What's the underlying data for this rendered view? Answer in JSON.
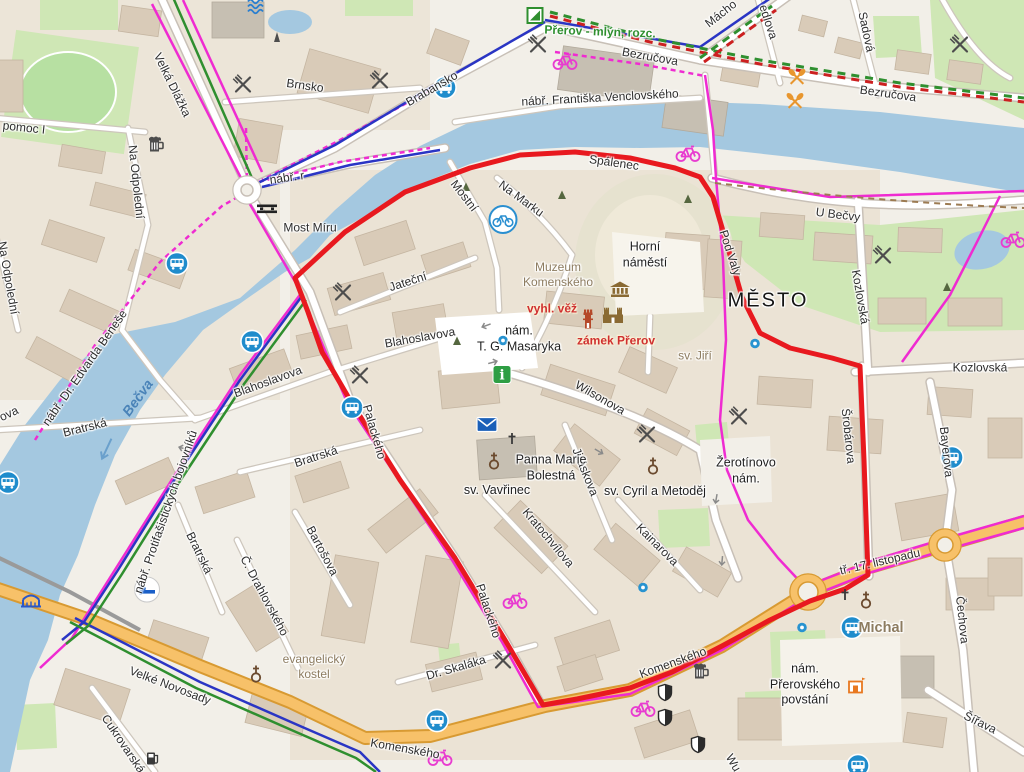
{
  "map": {
    "kind": "city-map",
    "city_label": "MĚSTO",
    "colors": {
      "water": "#a4c8e0",
      "land": "#f2efe8",
      "park": "#cfe7b5",
      "building": "#d9cbb8",
      "road_major": "#f7c169",
      "route_red": "#e8191f",
      "cycle_pink": "#ef2bd1",
      "cycle_blue": "#2a35c4",
      "hiking_green": "#2f8f2f",
      "hiking_red": "#cc2020"
    },
    "route": {
      "color": "#e8191f",
      "width": 5,
      "points": [
        [
          295,
          278
        ],
        [
          345,
          232
        ],
        [
          405,
          192
        ],
        [
          470,
          168
        ],
        [
          520,
          155
        ],
        [
          575,
          152
        ],
        [
          630,
          158
        ],
        [
          675,
          168
        ],
        [
          700,
          177
        ],
        [
          713,
          197
        ],
        [
          728,
          248
        ],
        [
          742,
          297
        ],
        [
          760,
          333
        ],
        [
          790,
          348
        ],
        [
          832,
          358
        ],
        [
          860,
          366
        ],
        [
          864,
          460
        ],
        [
          868,
          575
        ],
        [
          845,
          589
        ],
        [
          810,
          601
        ],
        [
          770,
          620
        ],
        [
          722,
          646
        ],
        [
          672,
          672
        ],
        [
          630,
          688
        ],
        [
          577,
          699
        ],
        [
          543,
          705
        ],
        [
          505,
          640
        ],
        [
          455,
          558
        ],
        [
          400,
          480
        ],
        [
          350,
          400
        ],
        [
          322,
          352
        ],
        [
          308,
          312
        ],
        [
          295,
          278
        ]
      ]
    },
    "labels": [
      {
        "t": "Velká Dlážka",
        "x": 172,
        "y": 85,
        "r": 64
      },
      {
        "t": "pomoc I",
        "x": 24,
        "y": 128,
        "r": 6
      },
      {
        "t": "Na Odpolední",
        "x": 136,
        "y": 182,
        "r": 84
      },
      {
        "t": "Na Odpolední",
        "x": 8,
        "y": 278,
        "r": 80
      },
      {
        "t": "Brnsko",
        "x": 305,
        "y": 86,
        "r": 8
      },
      {
        "t": "Brabansko",
        "x": 432,
        "y": 89,
        "r": -30
      },
      {
        "t": "nábř. r",
        "x": 287,
        "y": 178,
        "r": -8
      },
      {
        "t": "Bezručova",
        "x": 650,
        "y": 57,
        "r": 10
      },
      {
        "t": "Bezručova",
        "x": 888,
        "y": 94,
        "r": 8
      },
      {
        "t": "edlova",
        "x": 768,
        "y": 22,
        "r": 72
      },
      {
        "t": "Mácho",
        "x": 721,
        "y": 14,
        "r": -38
      },
      {
        "t": "Sadová",
        "x": 866,
        "y": 32,
        "r": 78
      },
      {
        "t": "nábř. Františka Venclovského",
        "x": 600,
        "y": 98,
        "r": -3
      },
      {
        "t": "Most Míru",
        "x": 310,
        "y": 228,
        "r": 0
      },
      {
        "t": "Spálenec",
        "x": 614,
        "y": 163,
        "r": 8
      },
      {
        "t": "Mostní",
        "x": 464,
        "y": 196,
        "r": 52
      },
      {
        "t": "Na Marku",
        "x": 521,
        "y": 199,
        "r": 36
      },
      {
        "t": "U Bečvy",
        "x": 838,
        "y": 215,
        "r": 7
      },
      {
        "t": "Pod Valy",
        "x": 730,
        "y": 253,
        "r": 72
      },
      {
        "t": "Kozlovská",
        "x": 860,
        "y": 297,
        "r": 80
      },
      {
        "t": "Kozlovská",
        "x": 980,
        "y": 368,
        "r": 0
      },
      {
        "t": "Jateční",
        "x": 408,
        "y": 282,
        "r": -18
      },
      {
        "t": "Blahoslavova",
        "x": 420,
        "y": 338,
        "r": -10
      },
      {
        "t": "Blahoslavova",
        "x": 268,
        "y": 382,
        "r": -20
      },
      {
        "t": "Wilsonova",
        "x": 600,
        "y": 398,
        "r": 30
      },
      {
        "t": "Šrobárova",
        "x": 848,
        "y": 436,
        "r": 84
      },
      {
        "t": "Bayerova",
        "x": 946,
        "y": 452,
        "r": 84
      },
      {
        "t": "Bratrská",
        "x": 85,
        "y": 428,
        "r": -14
      },
      {
        "t": "Bratrská",
        "x": 316,
        "y": 457,
        "r": -18
      },
      {
        "t": "Bratrská",
        "x": 199,
        "y": 553,
        "r": 64
      },
      {
        "t": "Bartošova",
        "x": 322,
        "y": 551,
        "r": 62
      },
      {
        "t": "nábř. Dr. Edvarda Beneše",
        "x": 85,
        "y": 368,
        "r": -55
      },
      {
        "t": "nábř. Protifašistických bojovníků",
        "x": 166,
        "y": 512,
        "r": -71
      },
      {
        "t": "Jiráskova",
        "x": 585,
        "y": 472,
        "r": 68
      },
      {
        "t": "Kratochvílova",
        "x": 548,
        "y": 538,
        "r": 50
      },
      {
        "t": "Kainarova",
        "x": 657,
        "y": 545,
        "r": 45
      },
      {
        "t": "Č. Drahlovského",
        "x": 264,
        "y": 596,
        "r": 62
      },
      {
        "t": "Dr. Skaláka",
        "x": 456,
        "y": 668,
        "r": -16
      },
      {
        "t": "Palackého",
        "x": 374,
        "y": 432,
        "r": 74
      },
      {
        "t": "Palackého",
        "x": 488,
        "y": 611,
        "r": 72
      },
      {
        "t": "Komenského",
        "x": 405,
        "y": 749,
        "r": 10
      },
      {
        "t": "Komenského",
        "x": 673,
        "y": 663,
        "r": -20
      },
      {
        "t": "tř. 17. listopadu",
        "x": 880,
        "y": 562,
        "r": -13
      },
      {
        "t": "Šířava",
        "x": 980,
        "y": 723,
        "r": 26
      },
      {
        "t": "Čechova",
        "x": 962,
        "y": 620,
        "r": 84
      },
      {
        "t": "Velké Novosady",
        "x": 170,
        "y": 686,
        "r": 21
      },
      {
        "t": "Cukrovarská",
        "x": 123,
        "y": 744,
        "r": 56
      },
      {
        "t": "Wu",
        "x": 733,
        "y": 763,
        "r": 60
      },
      {
        "t": "ova",
        "x": 9,
        "y": 414,
        "r": -25
      },
      {
        "t": "Horní\nnáměstí",
        "x": 645,
        "y": 255,
        "r": 0,
        "c": "pl"
      },
      {
        "t": "nám.\nT. G. Masaryka",
        "x": 519,
        "y": 339,
        "r": 0,
        "c": "pl"
      },
      {
        "t": "Žerotínovo\nnám.",
        "x": 746,
        "y": 471,
        "r": 0,
        "c": "pl"
      },
      {
        "t": "Panna Marie\nBolestná",
        "x": 551,
        "y": 468,
        "r": 0,
        "c": "pl"
      },
      {
        "t": "sv. Vavřinec",
        "x": 497,
        "y": 491,
        "r": 0,
        "c": "pl"
      },
      {
        "t": "sv. Cyril a Metoděj",
        "x": 655,
        "y": 492,
        "r": 0,
        "c": "pl"
      },
      {
        "t": "nám.\nPřerovského\npovstání",
        "x": 805,
        "y": 685,
        "r": 0,
        "c": "pl"
      },
      {
        "t": "MĚSTO",
        "x": 768,
        "y": 301,
        "r": 0,
        "c": "city"
      },
      {
        "t": "Muzeum\nKomenského",
        "x": 558,
        "y": 275,
        "r": 0,
        "c": "poi"
      },
      {
        "t": "sv. Jiří",
        "x": 695,
        "y": 356,
        "r": 0,
        "c": "poi"
      },
      {
        "t": "evangelický\nkostel",
        "x": 314,
        "y": 667,
        "r": 0,
        "c": "poi"
      },
      {
        "t": "Michal",
        "x": 881,
        "y": 628,
        "r": 0,
        "c": "poi-lg"
      },
      {
        "t": "vyhl. věž",
        "x": 552,
        "y": 309,
        "r": 0,
        "c": "poi-red"
      },
      {
        "t": "zámek Přerov",
        "x": 616,
        "y": 341,
        "r": 0,
        "c": "poi-red"
      },
      {
        "t": "Přerov - mlýn, rozc.",
        "x": 600,
        "y": 32,
        "r": 2,
        "c": "poi-green"
      },
      {
        "t": "Bečva",
        "x": 138,
        "y": 398,
        "r": -54,
        "c": "water"
      }
    ],
    "icons": [
      {
        "n": "bus-stop",
        "x": 445,
        "y": 90
      },
      {
        "n": "bus-stop",
        "x": 177,
        "y": 266
      },
      {
        "n": "bus-stop",
        "x": 252,
        "y": 344
      },
      {
        "n": "bus-stop",
        "x": 8,
        "y": 485
      },
      {
        "n": "bus-stop",
        "x": 352,
        "y": 410
      },
      {
        "n": "bus-stop",
        "x": 952,
        "y": 460
      },
      {
        "n": "bus-stop",
        "x": 852,
        "y": 630
      },
      {
        "n": "bus-stop",
        "x": 437,
        "y": 723
      },
      {
        "n": "bus-stop",
        "x": 858,
        "y": 768
      },
      {
        "n": "hotel",
        "x": 147,
        "y": 592
      },
      {
        "n": "restaurant",
        "x": 243,
        "y": 87
      },
      {
        "n": "restaurant",
        "x": 380,
        "y": 83
      },
      {
        "n": "restaurant",
        "x": 538,
        "y": 47
      },
      {
        "n": "restaurant",
        "x": 960,
        "y": 47
      },
      {
        "n": "restaurant",
        "x": 343,
        "y": 295
      },
      {
        "n": "restaurant",
        "x": 360,
        "y": 378
      },
      {
        "n": "restaurant",
        "x": 647,
        "y": 437
      },
      {
        "n": "restaurant",
        "x": 739,
        "y": 419
      },
      {
        "n": "restaurant",
        "x": 883,
        "y": 258
      },
      {
        "n": "restaurant",
        "x": 503,
        "y": 663
      },
      {
        "n": "pub",
        "x": 155,
        "y": 146
      },
      {
        "n": "pub",
        "x": 700,
        "y": 673
      },
      {
        "n": "cycle",
        "x": 565,
        "y": 62
      },
      {
        "n": "cycle",
        "x": 688,
        "y": 154
      },
      {
        "n": "cycle",
        "x": 1013,
        "y": 240
      },
      {
        "n": "cycle",
        "x": 515,
        "y": 601
      },
      {
        "n": "cycle",
        "x": 440,
        "y": 758
      },
      {
        "n": "cycle",
        "x": 643,
        "y": 709
      },
      {
        "n": "bike-share",
        "x": 503,
        "y": 222
      },
      {
        "n": "paddle",
        "x": 797,
        "y": 80
      },
      {
        "n": "paddle",
        "x": 795,
        "y": 104
      },
      {
        "n": "guidepost",
        "x": 535,
        "y": 18
      },
      {
        "n": "weir",
        "x": 267,
        "y": 212
      },
      {
        "n": "bridge",
        "x": 31,
        "y": 603
      },
      {
        "n": "fuel",
        "x": 153,
        "y": 761
      },
      {
        "n": "waves",
        "x": 257,
        "y": 8
      },
      {
        "n": "obelisk",
        "x": 277,
        "y": 40
      },
      {
        "n": "info",
        "x": 502,
        "y": 377
      },
      {
        "n": "post-office",
        "x": 487,
        "y": 427
      },
      {
        "n": "church",
        "x": 494,
        "y": 463
      },
      {
        "n": "church",
        "x": 256,
        "y": 676
      },
      {
        "n": "church",
        "x": 653,
        "y": 468
      },
      {
        "n": "church",
        "x": 866,
        "y": 602
      },
      {
        "n": "cross",
        "x": 845,
        "y": 597
      },
      {
        "n": "cross",
        "x": 512,
        "y": 441
      },
      {
        "n": "museum",
        "x": 620,
        "y": 292
      },
      {
        "n": "tower",
        "x": 588,
        "y": 322
      },
      {
        "n": "castle",
        "x": 613,
        "y": 318
      },
      {
        "n": "shield",
        "x": 665,
        "y": 695
      },
      {
        "n": "shield",
        "x": 665,
        "y": 720
      },
      {
        "n": "shield",
        "x": 698,
        "y": 747
      },
      {
        "n": "theater",
        "x": 857,
        "y": 688
      },
      {
        "n": "blue-dot",
        "x": 755,
        "y": 345
      },
      {
        "n": "blue-dot",
        "x": 643,
        "y": 589
      },
      {
        "n": "blue-dot",
        "x": 802,
        "y": 629
      },
      {
        "n": "blue-dot",
        "x": 503,
        "y": 342
      },
      {
        "n": "tree",
        "x": 466,
        "y": 188
      },
      {
        "n": "tree",
        "x": 562,
        "y": 196
      },
      {
        "n": "tree",
        "x": 688,
        "y": 200
      },
      {
        "n": "tree",
        "x": 457,
        "y": 342
      },
      {
        "n": "tree",
        "x": 947,
        "y": 288
      },
      {
        "n": "oneway-arrow",
        "x": 485,
        "y": 326,
        "r": 160
      },
      {
        "n": "oneway-arrow",
        "x": 494,
        "y": 362,
        "r": -15
      },
      {
        "n": "oneway-arrow",
        "x": 600,
        "y": 452,
        "r": 30
      },
      {
        "n": "oneway-arrow",
        "x": 716,
        "y": 500,
        "r": 100
      },
      {
        "n": "oneway-arrow",
        "x": 182,
        "y": 448,
        "r": 195
      },
      {
        "n": "oneway-arrow",
        "x": 722,
        "y": 562,
        "r": 95
      },
      {
        "n": "flow-arrow",
        "x": 105,
        "y": 450,
        "r": 115
      }
    ]
  }
}
